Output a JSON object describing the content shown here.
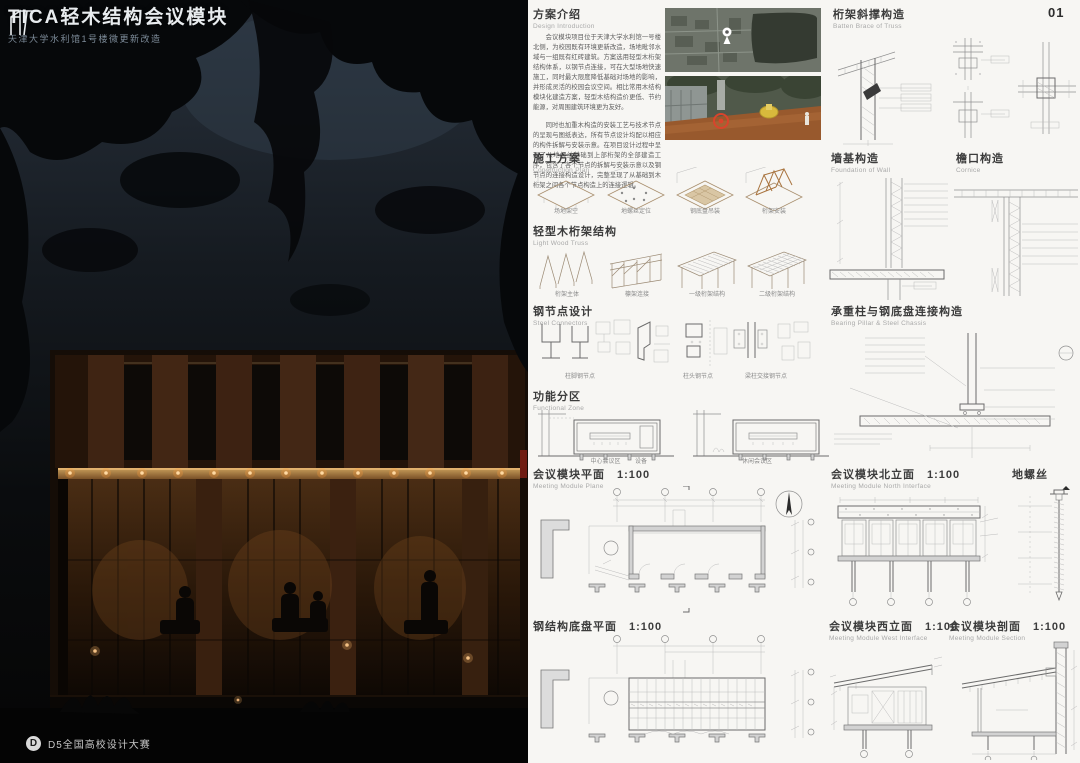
{
  "page": {
    "number": "01"
  },
  "left_panel": {
    "title": "TICA轻木结构会议模块",
    "subtitle": "天津大学水利馆1号楼微更新改造",
    "footer_logo": "D",
    "footer": "D5全国高校设计大赛"
  },
  "colors": {
    "accent_warm_light": "#ffd9a2",
    "sheet_bg": "#f7f6f3",
    "ink": "#3c3c3c",
    "drawing_line": "#8f8f8f"
  },
  "sections": {
    "intro": {
      "title": "方案介绍",
      "subtitle": "Design Introduction",
      "p1": "会议模块项目位于天津大学水利馆一号楼北侧，为校园既有环境更新改造，场地毗邻水域与一组既有红砖建筑。方案选用轻型木桁架结构体系，以钢节点连接，可在大型场地快速施工，同时最大限度降低基础对场地的影响，并形成灵活的校园会议空间。相比常用木结构模块化建造方案，轻型木结构造价更低、节约能源，对周围建筑环境更为友好。",
      "p2": "同时也加重木构造的安装工艺与技术节点的呈现与图纸表达，所有节点设计均配以相应的构件拆解与安装示意。在项目设计过程中呈现了从地螺丝基础到上部桁架的全部建造工序，包含了各个节点的拆解与安装示意以及钢节点的连接构造设计，完整呈现了从基础到木桁架之间各个节点构造上的连接逻辑。"
    },
    "truss_brace": {
      "title": "桁架斜撑构造",
      "subtitle": "Batten Brace of Truss"
    },
    "construction": {
      "title": "施工方案",
      "subtitle": "Construction Plan",
      "steps": [
        "场地架空",
        "地螺丝定位",
        "钢底盘吊装",
        "桁架安装"
      ]
    },
    "wall_foundation": {
      "title": "墙基构造",
      "subtitle": "Foundation of Wall"
    },
    "cornice": {
      "title": "檐口构造",
      "subtitle": "Cornice"
    },
    "truss": {
      "title": "轻型木桁架结构",
      "subtitle": "Light Wood Truss",
      "steps": [
        "桁架主体",
        "檩架连接",
        "一级桁架结构",
        "二级桁架结构"
      ]
    },
    "steel_nodes": {
      "title": "钢节点设计",
      "subtitle": "Steel Connectors",
      "labels": [
        "柱脚钢节点",
        "柱头钢节点",
        "梁柱交接钢节点"
      ]
    },
    "pillar_chassis": {
      "title": "承重柱与钢底盘连接构造",
      "subtitle": "Bearing Pillar & Steel Chassis"
    },
    "functional": {
      "title": "功能分区",
      "subtitle": "Functional Zone",
      "labels": [
        "中心会议区",
        "设备",
        "休闲会议区"
      ]
    },
    "plan": {
      "title": "会议模块平面",
      "scale": "1:100",
      "subtitle": "Meeting Module Plane"
    },
    "north_elev": {
      "title": "会议模块北立面",
      "scale": "1:100",
      "subtitle": "Meeting Module North Interface"
    },
    "ground_screw": {
      "title": "地螺丝"
    },
    "chassis_plan": {
      "title": "钢结构底盘平面",
      "scale": "1:100"
    },
    "west_elev": {
      "title": "会议模块西立面",
      "scale": "1:100",
      "subtitle": "Meeting Module West Interface"
    },
    "section": {
      "title": "会议模块剖面",
      "scale": "1:100",
      "subtitle": "Meeting Module Section"
    }
  }
}
